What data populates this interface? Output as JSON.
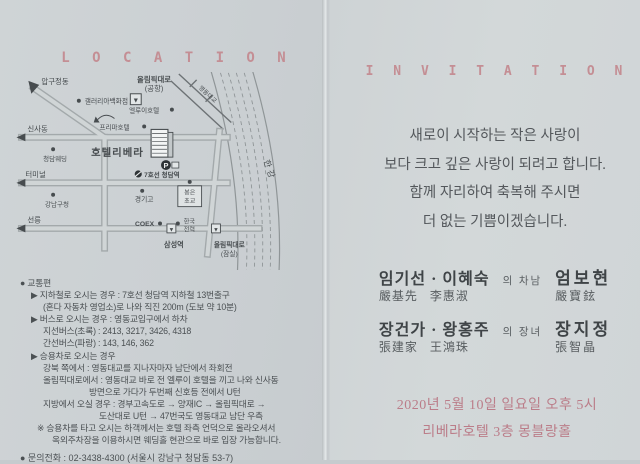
{
  "colors": {
    "accent_rose": "#c48e94",
    "date_pink": "#bb7d89",
    "paper_left": "#cbd0d3",
    "paper_right": "#d2d7d9",
    "ink": "#4b5053"
  },
  "left_page": {
    "title": "L O C A T I O N",
    "map": {
      "labels": {
        "olympic_airport_line1": "올림픽대로",
        "olympic_airport_line2": "(공항)",
        "apgujeongdong": "압구정동",
        "galleria_dept": "갤러리아백화점",
        "sinsadong": "신사동",
        "cheongdam_wedding": "청담웨딩",
        "terminal": "터미널",
        "gangnam_gu_office": "강남구청",
        "seolleung": "선릉",
        "prima_hotel": "프리마호텔",
        "ellui_hotel": "엘루이호텔",
        "hotel_riviera": "호텔리베라",
        "parking": "P",
        "line7_cheongdam_station": "7호선 청담역",
        "yeongdong_bridge": "영동대교",
        "han_river": "한강",
        "kyunggi_high_school": "경기고",
        "bongeun_elem_line1": "봉은",
        "bongeun_elem_line2": "초교",
        "coex": "COEX",
        "kepco_line1": "한국",
        "kepco_line2": "전력",
        "samseong_station": "삼성역",
        "olympic_jamsil_line1": "올림픽대로",
        "olympic_jamsil_line2": "(잠실)",
        "down_arrow": "▼"
      }
    },
    "transport_lines": [
      "● 교통편",
      "▶ 지하철로 오시는 경우 : 7호선 청담역 지하철 13번출구",
      "(혼다 자동차 영업소)로 나와 직진 200m (도보 약 10분)",
      "▶ 버스로 오시는 경우 : 영동교입구에서 하차",
      "지선버스(초록) : 2413, 3217, 3426, 4318",
      "간선버스(파랑) : 143, 146, 362",
      "▶ 승용차로 오시는 경우",
      "강북 쪽에서 : 영동대교를 지나자마자 남단에서 좌회전",
      "올림픽대로에서 : 영동대교 바로 전 엘루이 호텔을 끼고 나와 신사동",
      "방면으로 가다가 두번째 신호등 전에서 U턴",
      "지방에서 오실 경우 : 경부고속도로 → 양재IC → 올림픽대로 →",
      "도산대로 U턴 → 47번국도 영동대교 남단 우측",
      "※ 승용차를 타고 오시는 하객께서는 호텔 좌측 언덕으로 올라오셔서",
      "옥외주차장을 이용하시면 웨딩홀 현관으로 바로 입장 가능합니다."
    ],
    "phone": "● 문의전화 : 02-3438-4300 (서울시 강남구 청담동 53-7)"
  },
  "right_page": {
    "title": "I N V I T A T I O N",
    "message_lines": [
      "새로이 시작하는 작은 사랑이",
      "보다 크고 깊은 사랑이 되려고 합니다.",
      "함께 자리하여 축복해 주시면",
      "더 없는 기쁨이겠습니다."
    ],
    "families": [
      {
        "parents": "임기선 · 이혜숙",
        "relation": "의 차남",
        "child": "엄보현",
        "parents_hanja": "嚴基先   李惠淑",
        "child_hanja": "嚴寶鉉"
      },
      {
        "parents": "장건가 · 왕홍주",
        "relation": "의 장녀",
        "child": "장지정",
        "parents_hanja": "張建家   王鴻珠",
        "child_hanja": "張智晶"
      }
    ],
    "datetime": "2020년 5월 10일 일요일 오후 5시",
    "venue": "리베라호텔 3층 몽블랑홀"
  }
}
